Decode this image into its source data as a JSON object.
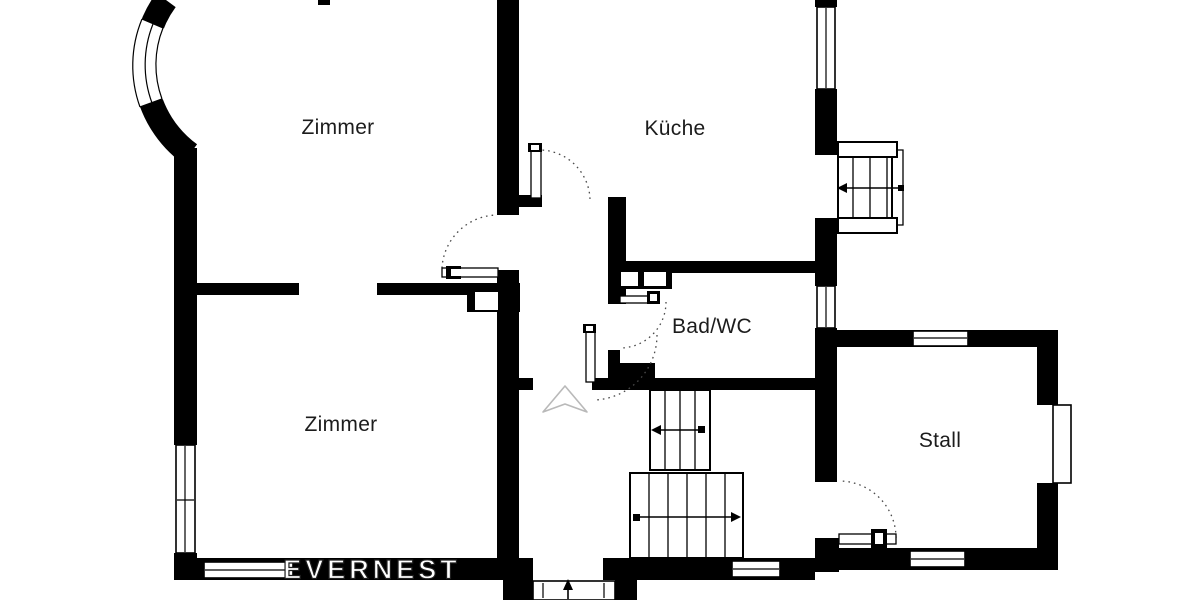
{
  "plan": {
    "background": "#ffffff",
    "wall_color": "#000000",
    "label_color": "#1c1c1c",
    "rooms": [
      {
        "id": "zimmer-top",
        "label": "Zimmer"
      },
      {
        "id": "kueche",
        "label": "Küche"
      },
      {
        "id": "bad-wc",
        "label": "Bad/WC"
      },
      {
        "id": "zimmer-bottom",
        "label": "Zimmer"
      },
      {
        "id": "stall",
        "label": "Stall"
      }
    ],
    "watermark": {
      "text": "EVERNEST",
      "fill": "#ffffff",
      "outline": "#1f1f1f"
    }
  }
}
